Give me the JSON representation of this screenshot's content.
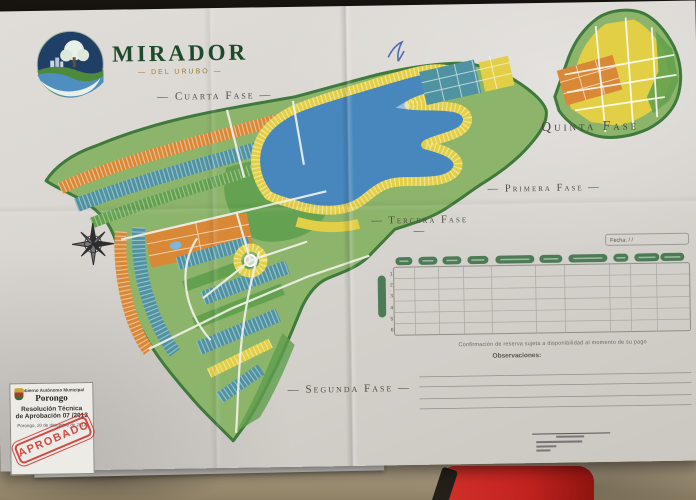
{
  "logo": {
    "title": "MIRADOR",
    "subtitle": "— DEL URUBO —"
  },
  "phase_labels": {
    "cuarta": "— Cuarta Fase —",
    "quinta": "Quinta Fase",
    "primera": "— Primera Fase —",
    "tercera": "— Tercera Fase —",
    "segunda": "— Segunda Fase —"
  },
  "reservation_table": {
    "date_field": "Fecha:        /        /",
    "column_count": 10,
    "row_numbers": [
      "1",
      "2",
      "3",
      "4",
      "5",
      "6"
    ],
    "note": "Confirmación de reserva sujeta a disponibilidad al momento de su pago",
    "observations_label": "Observaciones:"
  },
  "approval_box": {
    "government": "Gobierno Autónomo Municipal",
    "municipality": "Porongo",
    "resolution_line1": "Resolución Técnica",
    "resolution_line2": "de Aprobación 07 /2013",
    "date_line": "Porongo, 20 de diciembre de 2013",
    "stamp": "APROBADO"
  },
  "colors": {
    "paper": "#d8d5d0",
    "background": "#1b1815",
    "couch": "#b3a489",
    "red_cloth": "#c32320",
    "map_border_green": "#3f7a3c",
    "map_green": "#8cb46b",
    "park_green": "#5f9e4e",
    "lot_teal": "#4f93a2",
    "lot_yellow": "#e3cf45",
    "lot_orange": "#d98836",
    "lagoon_blue": "#4787bd",
    "table_pill_green": "#4c7b55",
    "stamp_red": "#c9231e",
    "brand_green": "#1d4a2c"
  }
}
